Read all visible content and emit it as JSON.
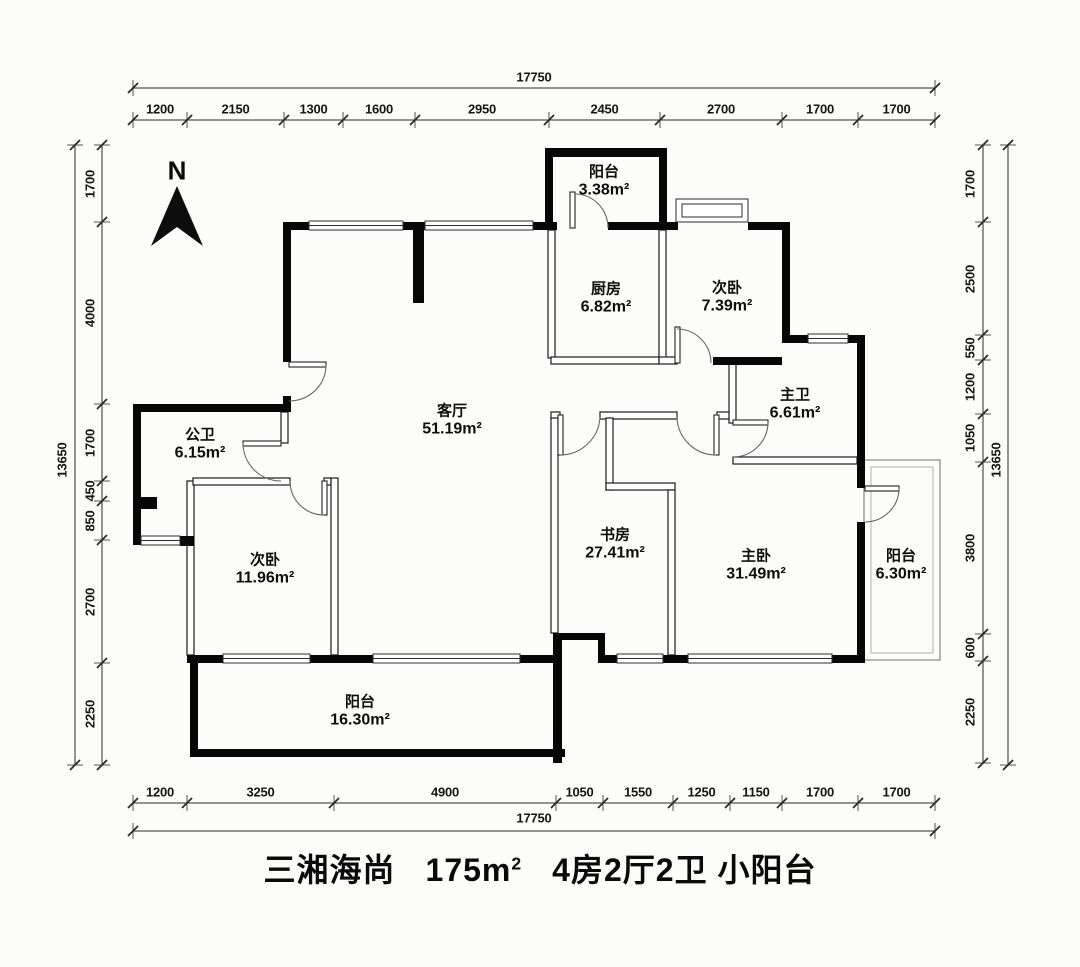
{
  "title": {
    "project": "三湘海尚",
    "area_value": "175",
    "area_unit_m": "m",
    "area_unit_sup": "2",
    "spec": "4房2厅2卫",
    "tag": "小阳台"
  },
  "north_label": "N",
  "rooms": [
    {
      "id": "balcony-north",
      "name": "阳台",
      "area": "3.38m²"
    },
    {
      "id": "kitchen",
      "name": "厨房",
      "area": "6.82m²"
    },
    {
      "id": "bedroom-north",
      "name": "次卧",
      "area": "7.39m²"
    },
    {
      "id": "master-bath",
      "name": "主卫",
      "area": "6.61m²"
    },
    {
      "id": "living-room",
      "name": "客厅",
      "area": "51.19m²"
    },
    {
      "id": "guest-bath",
      "name": "公卫",
      "area": "6.15m²"
    },
    {
      "id": "bedroom-west",
      "name": "次卧",
      "area": "11.96m²"
    },
    {
      "id": "study",
      "name": "书房",
      "area": "27.41m²"
    },
    {
      "id": "master-bedroom",
      "name": "主卧",
      "area": "31.49m²"
    },
    {
      "id": "balcony-east",
      "name": "阳台",
      "area": "6.30m²"
    },
    {
      "id": "balcony-south",
      "name": "阳台",
      "area": "16.30m²"
    }
  ],
  "dimensions": {
    "top": {
      "total": "17750",
      "segments": [
        "1200",
        "2150",
        "1300",
        "1600",
        "2950",
        "2450",
        "2700",
        "1700",
        "1700"
      ]
    },
    "bottom": {
      "total": "17750",
      "segments": [
        "1200",
        "3250",
        "4900",
        "1050",
        "1550",
        "1250",
        "1150",
        "1700",
        "1700"
      ]
    },
    "left": {
      "total": "13650",
      "segments": [
        "1700",
        "4000",
        "1700",
        "450",
        "850",
        "2700",
        "2250"
      ]
    },
    "right": {
      "total": "13650",
      "segments": [
        "1700",
        "2500",
        "550",
        "1200",
        "1050",
        "3800",
        "600",
        "2250"
      ]
    }
  }
}
